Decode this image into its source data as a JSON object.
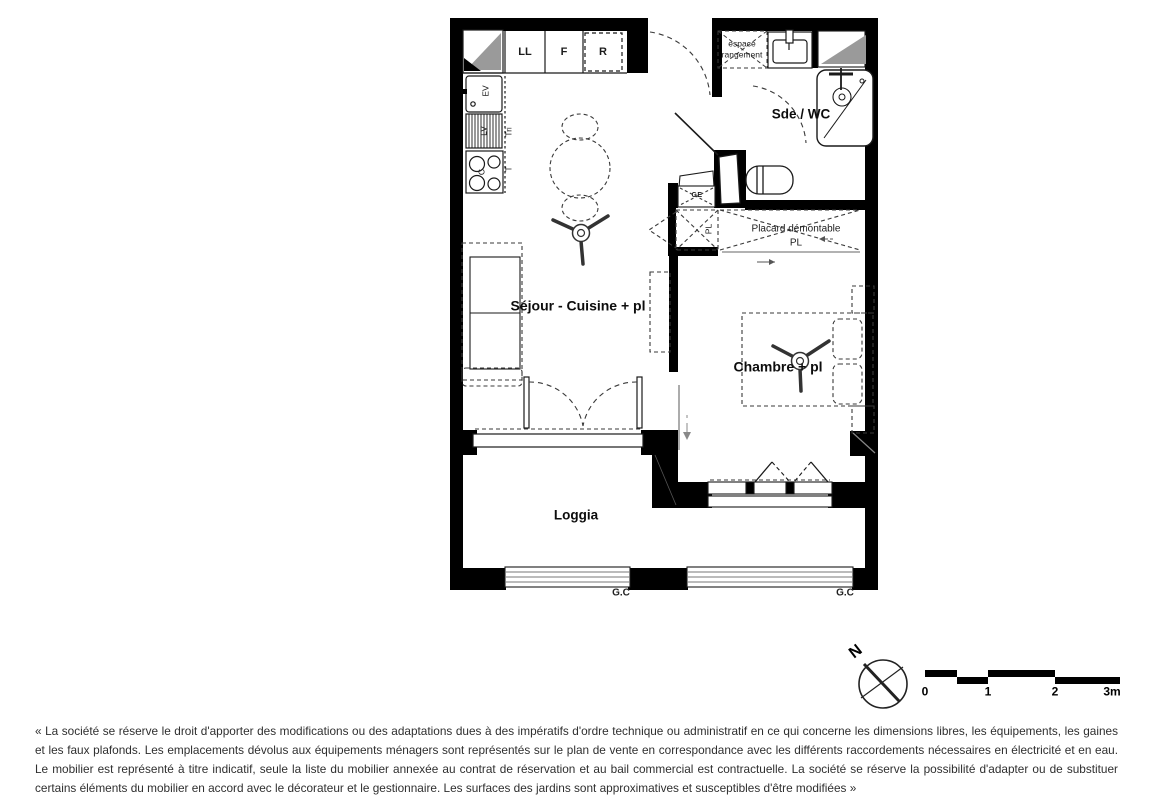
{
  "plan": {
    "rooms": {
      "sejour": "Séjour - Cuisine + pl",
      "chambre": "Chambre + pl",
      "sde_wc": "Sde / WC",
      "loggia": "Loggia"
    },
    "kitchen": {
      "units": [
        "LL",
        "F",
        "R"
      ],
      "sink": "EV",
      "dishwasher": "LV",
      "sorting": "Tri",
      "worktop": "T",
      "cooktop": "C"
    },
    "closets": {
      "hall_pl": "PL",
      "placard_line1": "Placard démontable",
      "placard_line2": "PL",
      "storage_line1": "espace",
      "storage_line2": "rangement",
      "duct": "GE"
    },
    "railings": {
      "left": "G.C",
      "right": "G.C"
    }
  },
  "compass": {
    "north": "N"
  },
  "scalebar": {
    "ticks": [
      "0",
      "1",
      "2",
      "3m"
    ]
  },
  "disclaimer": "« La société se réserve le droit d'apporter des modifications ou des adaptations dues à des impératifs d'ordre technique ou administratif en ce qui concerne les dimensions libres, les équipements, les gaines et les faux plafonds. Les emplacements dévolus aux équipements ménagers sont représentés sur le plan de vente en correspondance avec les différents raccordements nécessaires en électricité et en eau. Le mobilier est représenté à titre indicatif, seule la liste du mobilier annexée au contrat de réservation et au bail commercial est contractuelle. La société se réserve la possibilité d'adapter ou de substituer certains éléments du mobilier en accord avec le décorateur et le gestionnaire. Les surfaces des jardins sont approximatives et susceptibles d'être modifiées »",
  "colors": {
    "wall": "#000000",
    "shaft_gray": "#9a9a9a",
    "line": "#1a1a1a",
    "dash": "#3a3a3a"
  }
}
